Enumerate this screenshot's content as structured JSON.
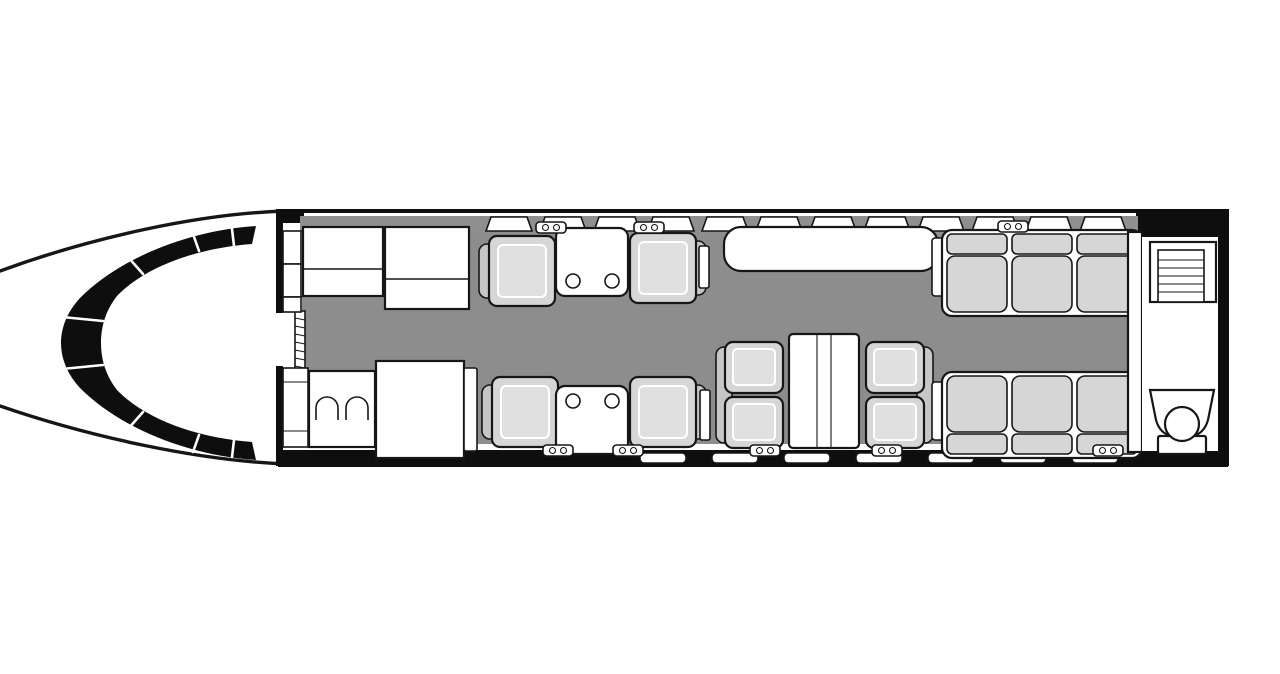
{
  "diagram": {
    "type": "aircraft-cabin-floor-plan",
    "orientation": "nose-left",
    "colors": {
      "white": "#ffffff",
      "black": "#0e0e0e",
      "outline": "#161616",
      "floor": "#8d8d8d",
      "wall": "#8f8f8f",
      "seat": "#d6d6d6",
      "seatback": "#c6c6c6",
      "seatinner": "#e0e0e0"
    },
    "components": {
      "cockpit_windshield_panels": 8,
      "galley_counters": 2,
      "cockpit_bulkhead_cells": 3,
      "crew_bench_sections": 3,
      "forward_seat": 1,
      "wardrobe_closet": 1,
      "club_chairs": 4,
      "club_side_tables": 2,
      "cupholders_per_table": 2,
      "credenza": 1,
      "conference_two_place_sofas": 2,
      "conference_table": 1,
      "three_place_divans": 2,
      "lavatory_toilet": 1,
      "lavatory_vanity_shelves": 1,
      "windows_top": 12,
      "windows_bottom": 7,
      "wall_latches_top": 3,
      "wall_latches_bottom": 5
    }
  }
}
